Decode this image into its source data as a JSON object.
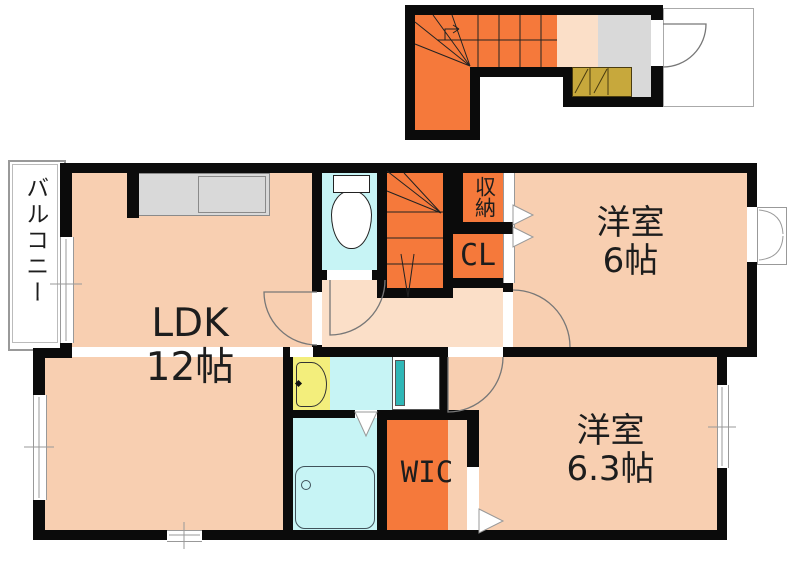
{
  "plan_title": "apartment-floor-plan",
  "rooms": {
    "balcony": {
      "label": "バルコニー"
    },
    "ldk": {
      "label": "LDK",
      "size": "12帖"
    },
    "bedroom_upper": {
      "label": "洋室",
      "size": "6帖"
    },
    "bedroom_lower": {
      "label": "洋室",
      "size": "6.3帖"
    },
    "wic": {
      "label": "WIC"
    },
    "closet": {
      "label": "CL"
    },
    "storage": {
      "label": "収納"
    }
  },
  "colors": {
    "wall": "#0b0b0b",
    "room_peach": "#f8cfb1",
    "hallway_peach": "#fbdfc8",
    "accent_orange": "#f5793b",
    "water_cyan": "#c7f4f5",
    "sink_yellow": "#f3ee7c",
    "shoe_cabinet_olive": "#c7a83c",
    "fixture_gray": "#d9d9d9",
    "line_gray": "#999999"
  }
}
